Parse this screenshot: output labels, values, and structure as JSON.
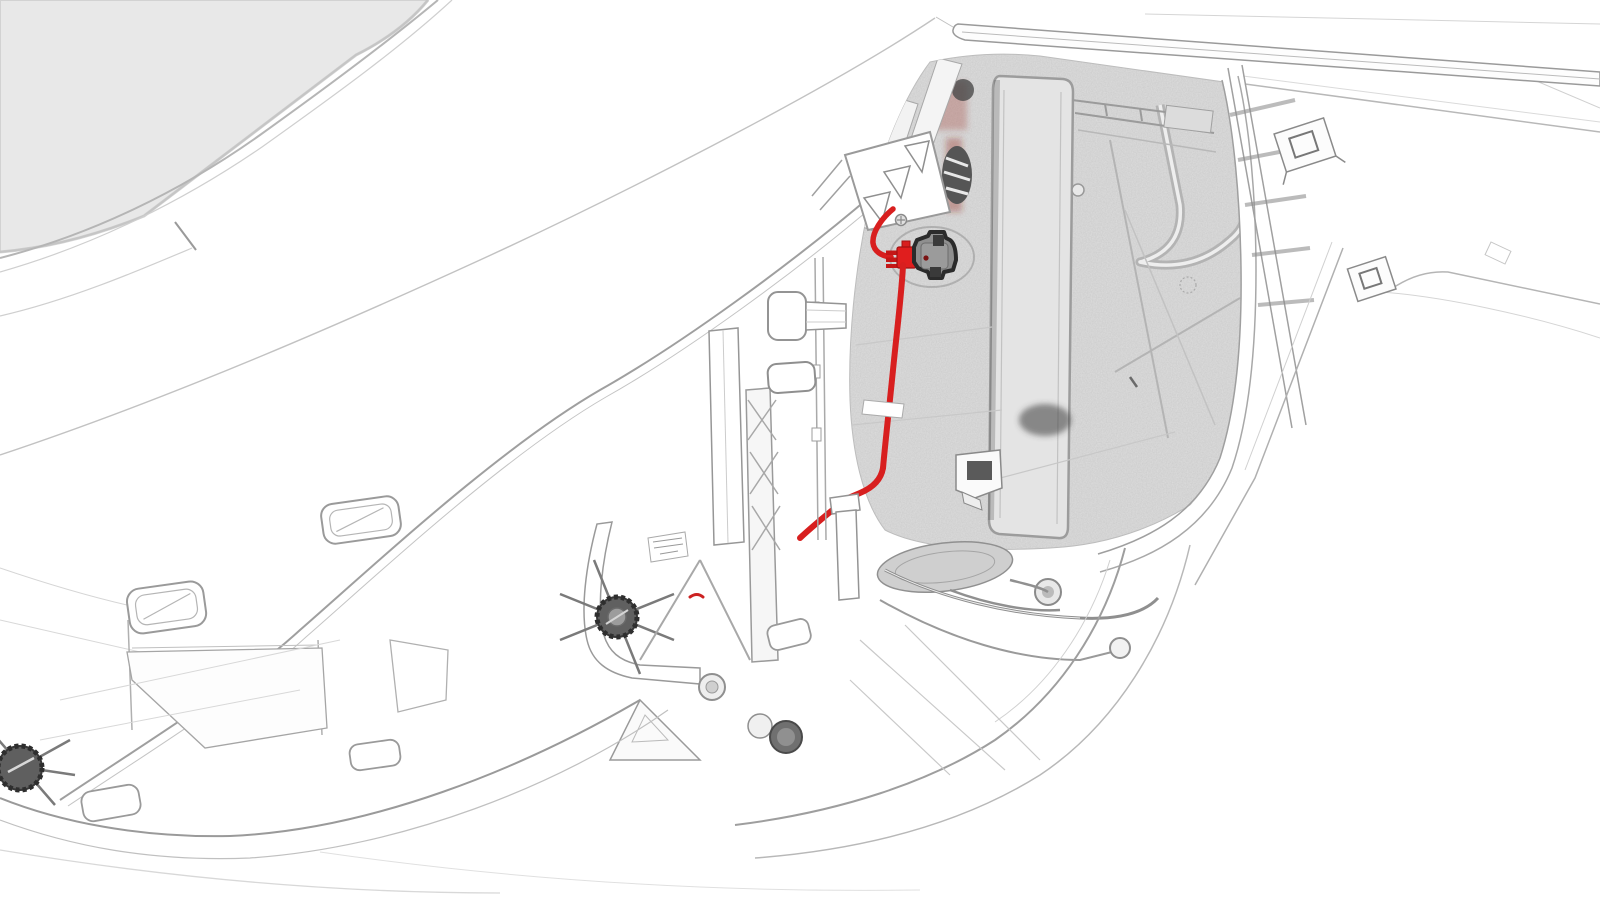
{
  "scene": {
    "description": "Service-manual technical line illustration of a vehicle front quarter (hood open, wheel and trim removed) with the hood latch cable routing highlighted in red",
    "highlighted_part": "hood-latch-with-release-cable",
    "legible_text": [],
    "style": "monochrome line art with red highlight"
  },
  "colors": {
    "background": "#ffffff",
    "glass": "#e8e8e8",
    "line_light": "#c9c9c9",
    "line_mid": "#9a9a9a",
    "line_dark": "#6f6f6f",
    "shade_fill": "#e0e0e0",
    "highlight_red": "#d81f1f",
    "highlight_red_dark": "#a31212",
    "component_dark": "#2b2b2b",
    "component_gray": "#8f8f8f"
  },
  "elements": [
    {
      "name": "windshield-glass",
      "kind": "body-panel"
    },
    {
      "name": "wiper-blade",
      "kind": "body-part"
    },
    {
      "name": "hood-cutline",
      "kind": "panel-line"
    },
    {
      "name": "fender-edge",
      "kind": "panel-line"
    },
    {
      "name": "frunk-compartment",
      "kind": "shaded-area"
    },
    {
      "name": "hood-latch",
      "kind": "highlighted-component"
    },
    {
      "name": "latch-connector-plug",
      "kind": "highlighted-component"
    },
    {
      "name": "latch-release-cable",
      "kind": "highlighted-route"
    },
    {
      "name": "latch-bracket-triangles",
      "kind": "bracket"
    },
    {
      "name": "hinge-pillar-posts",
      "kind": "structure"
    },
    {
      "name": "star-fastener",
      "kind": "fastener"
    },
    {
      "name": "suspension-cluster",
      "kind": "mechanical"
    },
    {
      "name": "wheel-arch-liner",
      "kind": "panel-line"
    },
    {
      "name": "door-hinge-brackets",
      "kind": "bracket"
    },
    {
      "name": "trim-slots",
      "kind": "panel-detail"
    },
    {
      "name": "underbody-panels",
      "kind": "panel-line"
    }
  ]
}
